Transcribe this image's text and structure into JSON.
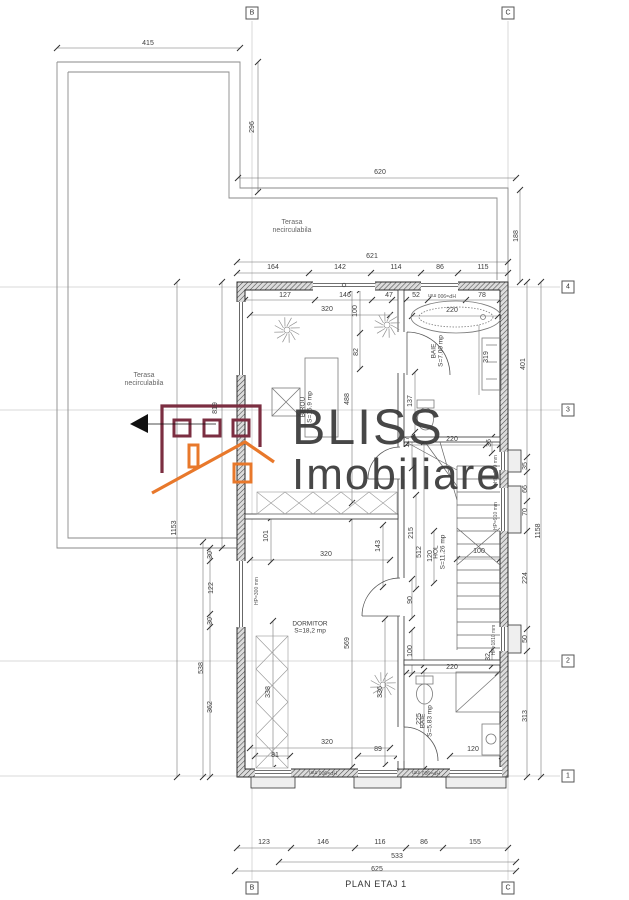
{
  "plan": {
    "title": "PLAN ETAJ 1"
  },
  "watermark": {
    "line1": "BLISS",
    "line2": "Imobiliare"
  },
  "colors": {
    "logo_maroon": "#7b2e41",
    "logo_orange": "#e8782b",
    "watermark_gray": "#3a3a3a",
    "arrow_black": "#111111"
  },
  "grid_markers": [
    {
      "label": "B",
      "x": 252,
      "y": 13
    },
    {
      "label": "C",
      "x": 508,
      "y": 13
    },
    {
      "label": "4",
      "x": 568,
      "y": 287
    },
    {
      "label": "3",
      "x": 568,
      "y": 410
    },
    {
      "label": "2",
      "x": 568,
      "y": 661
    },
    {
      "label": "1",
      "x": 568,
      "y": 776
    },
    {
      "label": "B",
      "x": 252,
      "y": 888
    },
    {
      "label": "C",
      "x": 508,
      "y": 888
    }
  ],
  "labels": [
    {
      "t": "415",
      "x": 148,
      "y": 44
    },
    {
      "t": "296",
      "x": 253,
      "y": 127,
      "r": -90
    },
    {
      "t": "620",
      "x": 380,
      "y": 173
    },
    {
      "t": "188",
      "x": 517,
      "y": 236,
      "r": -90
    },
    {
      "t": "621",
      "x": 372,
      "y": 257
    },
    {
      "t": "164",
      "x": 273,
      "y": 268
    },
    {
      "t": "142",
      "x": 340,
      "y": 268
    },
    {
      "t": "114",
      "x": 396,
      "y": 268
    },
    {
      "t": "86",
      "x": 440,
      "y": 268
    },
    {
      "t": "115",
      "x": 483,
      "y": 268
    },
    {
      "t": "127",
      "x": 285,
      "y": 296
    },
    {
      "t": "146",
      "x": 345,
      "y": 296
    },
    {
      "t": "47",
      "x": 389,
      "y": 296
    },
    {
      "t": "52",
      "x": 416,
      "y": 296
    },
    {
      "t": "78",
      "x": 482,
      "y": 296
    },
    {
      "t": "320",
      "x": 327,
      "y": 310
    },
    {
      "t": "100",
      "x": 356,
      "y": 311,
      "r": -90
    },
    {
      "t": "220",
      "x": 452,
      "y": 311
    },
    {
      "t": "82",
      "x": 357,
      "y": 352,
      "r": -90
    },
    {
      "t": "488",
      "x": 348,
      "y": 399,
      "r": -90
    },
    {
      "t": "137",
      "x": 411,
      "y": 401,
      "r": -90
    },
    {
      "t": "319",
      "x": 487,
      "y": 357,
      "r": -90
    },
    {
      "t": "401",
      "x": 524,
      "y": 364,
      "r": -90
    },
    {
      "t": "117",
      "x": 408,
      "y": 442,
      "r": -90
    },
    {
      "t": "220",
      "x": 452,
      "y": 440
    },
    {
      "t": "36",
      "x": 490,
      "y": 443,
      "r": -90
    },
    {
      "t": "215",
      "x": 412,
      "y": 533,
      "r": -90
    },
    {
      "t": "512",
      "x": 420,
      "y": 552,
      "r": -90
    },
    {
      "t": "120",
      "x": 431,
      "y": 556,
      "r": -90
    },
    {
      "t": "100",
      "x": 479,
      "y": 552
    },
    {
      "t": "90",
      "x": 411,
      "y": 600,
      "r": -90
    },
    {
      "t": "100",
      "x": 411,
      "y": 651,
      "r": -90
    },
    {
      "t": "101",
      "x": 267,
      "y": 536,
      "r": -90
    },
    {
      "t": "320",
      "x": 326,
      "y": 555
    },
    {
      "t": "143",
      "x": 379,
      "y": 546,
      "r": -90
    },
    {
      "t": "569",
      "x": 348,
      "y": 643,
      "r": -90
    },
    {
      "t": "338",
      "x": 269,
      "y": 692,
      "r": -90
    },
    {
      "t": "336",
      "x": 381,
      "y": 692,
      "r": -90
    },
    {
      "t": "35",
      "x": 526,
      "y": 466,
      "r": -90
    },
    {
      "t": "66",
      "x": 526,
      "y": 489,
      "r": -90
    },
    {
      "t": "70",
      "x": 526,
      "y": 512,
      "r": -90
    },
    {
      "t": "224",
      "x": 526,
      "y": 578,
      "r": -90
    },
    {
      "t": "50",
      "x": 526,
      "y": 639,
      "r": -90
    },
    {
      "t": "313",
      "x": 526,
      "y": 716,
      "r": -90
    },
    {
      "t": "1158",
      "x": 539,
      "y": 531,
      "r": -90
    },
    {
      "t": "32",
      "x": 489,
      "y": 657,
      "r": -90
    },
    {
      "t": "220",
      "x": 452,
      "y": 668
    },
    {
      "t": "225",
      "x": 420,
      "y": 719,
      "r": -90
    },
    {
      "t": "120",
      "x": 473,
      "y": 750
    },
    {
      "t": "89",
      "x": 378,
      "y": 750
    },
    {
      "t": "320",
      "x": 327,
      "y": 743
    },
    {
      "t": "81",
      "x": 275,
      "y": 756
    },
    {
      "t": "1153",
      "x": 175,
      "y": 528,
      "r": -90
    },
    {
      "t": "30",
      "x": 211,
      "y": 555,
      "r": -90
    },
    {
      "t": "122",
      "x": 212,
      "y": 588,
      "r": -90
    },
    {
      "t": "30",
      "x": 211,
      "y": 621,
      "r": -90
    },
    {
      "t": "538",
      "x": 202,
      "y": 668,
      "r": -90
    },
    {
      "t": "362",
      "x": 211,
      "y": 707,
      "r": -90
    },
    {
      "t": "819",
      "x": 216,
      "y": 408,
      "r": -90
    },
    {
      "t": "123",
      "x": 264,
      "y": 843
    },
    {
      "t": "146",
      "x": 323,
      "y": 843
    },
    {
      "t": "116",
      "x": 380,
      "y": 843
    },
    {
      "t": "86",
      "x": 424,
      "y": 843
    },
    {
      "t": "155",
      "x": 475,
      "y": 843
    },
    {
      "t": "533",
      "x": 397,
      "y": 857
    },
    {
      "t": "625",
      "x": 377,
      "y": 870
    },
    {
      "t": "HP=900 mm",
      "x": 442,
      "y": 294,
      "r": 180,
      "k": "hp"
    },
    {
      "t": "HP=900 mm",
      "x": 323,
      "y": 771,
      "r": 180,
      "k": "hp"
    },
    {
      "t": "HP=900 mm",
      "x": 426,
      "y": 771,
      "r": 180,
      "k": "hp"
    },
    {
      "t": "HP=300 mm",
      "x": 258,
      "y": 591,
      "r": -90,
      "k": "hp"
    },
    {
      "t": "HP=300 mm",
      "x": 497,
      "y": 469,
      "r": -90,
      "k": "hp"
    },
    {
      "t": "HP=910 mm",
      "x": 497,
      "y": 516,
      "r": -90,
      "k": "hp"
    },
    {
      "t": "HP=1810 mm",
      "x": 495,
      "y": 640,
      "r": -90,
      "k": "hp"
    },
    {
      "t": "BIROU\nS=15.9 mp",
      "x": 307,
      "y": 407,
      "r": -90,
      "k": "room"
    },
    {
      "t": "BAIE\nS=7.00 mp",
      "x": 438,
      "y": 351,
      "r": -90,
      "k": "room"
    },
    {
      "t": "HOL\nS=11.26 mp",
      "x": 440,
      "y": 552,
      "r": -90,
      "k": "room"
    },
    {
      "t": "DORMITOR\nS=18,2 mp",
      "x": 310,
      "y": 628,
      "k": "room"
    },
    {
      "t": "BAIE\nS=5.83 mp",
      "x": 427,
      "y": 721,
      "r": -90,
      "k": "room"
    },
    {
      "t": "Terasa\nnecirculabila",
      "x": 292,
      "y": 227,
      "k": "ter"
    },
    {
      "t": "Terasa\nnecirculabila",
      "x": 144,
      "y": 380,
      "k": "ter"
    },
    {
      "t": "PLAN ETAJ 1",
      "x": 376,
      "y": 884,
      "k": "title"
    }
  ]
}
